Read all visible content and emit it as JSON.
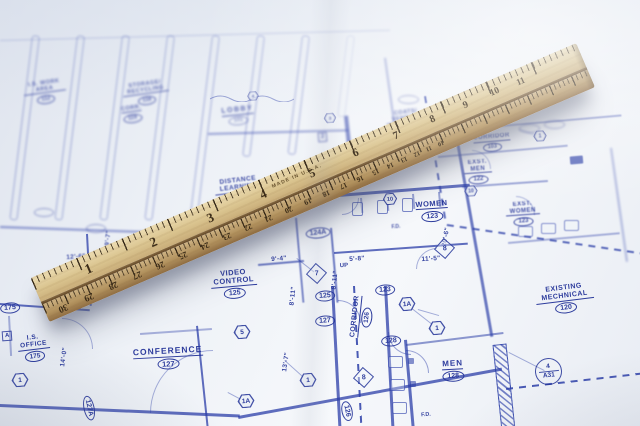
{
  "colors": {
    "ink": "#2b3ea8",
    "paper": "#eef2f7",
    "wood": "#c8ab7d",
    "shadow": "#555c73"
  },
  "rooms": {
    "iswork": {
      "name": "I.S. WORK AREA",
      "number": "112"
    },
    "storage": {
      "name": "STORAGE/ RECYCLING",
      "number": "118"
    },
    "corr": {
      "name": "CORR.",
      "number": "119"
    },
    "lobby": {
      "name": "LOBBY",
      "number": "101"
    },
    "coats": {
      "name": "COATS/ VENDING",
      "number": ""
    },
    "corridor103": {
      "name": "CORRIDOR",
      "number": "103"
    },
    "exstmen": {
      "name": "EXST. MEN",
      "number": "122"
    },
    "exstwomen": {
      "name": "EXST. WOMEN",
      "number": "123"
    },
    "existmech": {
      "name": "EXISTING MECHNICAL",
      "number": "120"
    },
    "distance": {
      "name": "DISTANCE LEARNING",
      "number": "124"
    },
    "women": {
      "name": "WOMEN",
      "number": "123"
    },
    "video": {
      "name": "VIDEO CONTROL",
      "number": "125"
    },
    "conference": {
      "name": "CONFERENCE",
      "number": "127"
    },
    "men": {
      "name": "MEN",
      "number": "128"
    },
    "corridor126": {
      "name": "CORRIDOR",
      "number": "126"
    },
    "isoffice": {
      "name": "I.S. OFFICE",
      "number": "175"
    }
  },
  "tags": {
    "t175": "175",
    "t124a": "124A",
    "t125": "125",
    "t127": "127",
    "t123": "123",
    "t128": "128",
    "t126": "126",
    "t127a": "127A"
  },
  "dimensions": {
    "d12_6": "12'-6\"",
    "d19_7": "19'-7\"",
    "d14_0": "14'-0\"",
    "d9_4": "9'-4\"",
    "d8_11": "8'-11\"",
    "d5_8": "5'-8\"",
    "d11_5": "11'-5\"",
    "d13_7": "13'-7\"",
    "d20_6": "20'-6\""
  },
  "callouts": {
    "one": "1",
    "oneA": "1A",
    "five": "5",
    "ten": "10",
    "three": "3",
    "four": "4",
    "seven": "7",
    "eight": "8",
    "two": "2",
    "a": "A",
    "detail_top": "4",
    "detail_bottom": "A31"
  },
  "texts": {
    "made_in": "MADE IN U.S.A.",
    "up": "UP",
    "fd": "F.D."
  },
  "ruler": {
    "inch_numbers": [
      "1",
      "2",
      "3",
      "4",
      "5",
      "6",
      "7",
      "8",
      "9",
      "10",
      "11"
    ],
    "cm_numbers": [
      "30",
      "29",
      "28",
      "27",
      "26",
      "25",
      "24",
      "23",
      "22",
      "21",
      "20",
      "19",
      "18",
      "17",
      "16",
      "15",
      "14",
      "13",
      "12",
      "11",
      "10"
    ]
  }
}
